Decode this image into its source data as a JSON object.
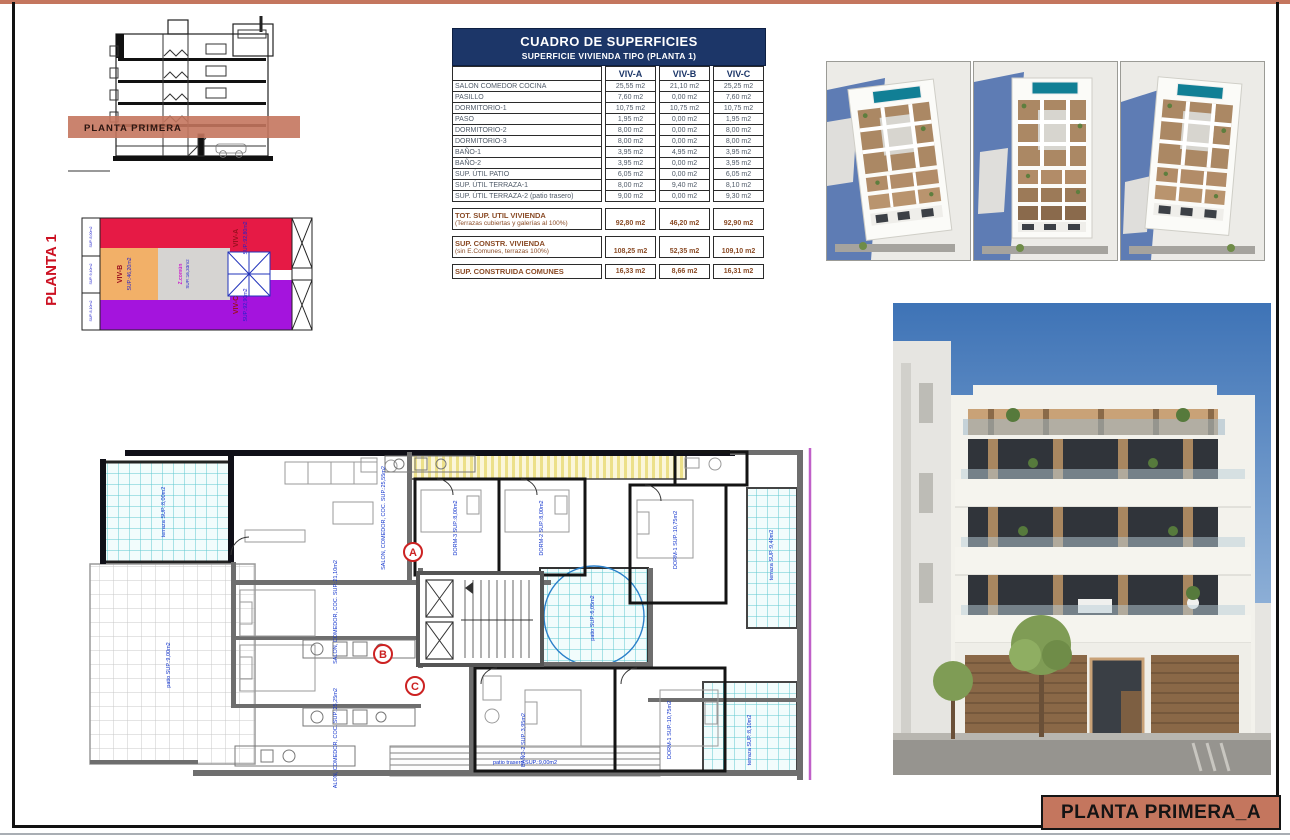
{
  "page": {
    "banner_title": "PLANTA PRIMERA_A",
    "accent_color": "#c4765e"
  },
  "section_drawing": {
    "band_label": "PLANTA PRIMERA"
  },
  "key_plan": {
    "title": "PLANTA 1",
    "units": [
      {
        "label": "VIV-A",
        "sup": "SUP.:92,80m2",
        "color": "#e61a45"
      },
      {
        "label": "VIV-B",
        "sup": "SUP.:46,20m2",
        "color": "#f2b068"
      },
      {
        "label": "VIV-C",
        "sup": "SUP.:92,90m2",
        "color": "#a414dd"
      },
      {
        "label": "Z.común",
        "sup": "SUP.:16,33m2",
        "color": "#d6d4d2"
      }
    ],
    "balcony_labels": [
      "SUP.:8,00m2",
      "SUP.:9,40m2",
      "SUP.:8,10m2"
    ]
  },
  "surface_table": {
    "title": "CUADRO DE SUPERFICIES",
    "subtitle": "SUPERFICIE VIVIENDA TIPO  (PLANTA 1)",
    "columns": {
      "a": "VIV-A",
      "b": "VIV-B",
      "c": "VIV-C"
    },
    "rows": [
      {
        "label": "SALON COMEDOR COCINA",
        "a": "25,55 m2",
        "b": "21,10 m2",
        "c": "25,25 m2"
      },
      {
        "label": "PASILLO",
        "a": "7,60 m2",
        "b": "0,00 m2",
        "c": "7,60 m2"
      },
      {
        "label": "DORMITORIO-1",
        "a": "10,75 m2",
        "b": "10,75 m2",
        "c": "10,75 m2"
      },
      {
        "label": "PASO",
        "a": "1,95 m2",
        "b": "0,00 m2",
        "c": "1,95 m2"
      },
      {
        "label": "DORMITORIO-2",
        "a": "8,00 m2",
        "b": "0,00 m2",
        "c": "8,00 m2"
      },
      {
        "label": "DORMITORIO-3",
        "a": "8,00 m2",
        "b": "0,00 m2",
        "c": "8,00 m2"
      },
      {
        "label": "BAÑO-1",
        "a": "3,95 m2",
        "b": "4,95 m2",
        "c": "3,95 m2"
      },
      {
        "label": "BAÑO-2",
        "a": "3,95 m2",
        "b": "0,00 m2",
        "c": "3,95 m2"
      },
      {
        "label": "SUP. ÚTIL PATIO",
        "a": "6,05 m2",
        "b": "0,00 m2",
        "c": "6,05 m2"
      },
      {
        "label": "SUP. ÚTIL TERRAZA-1",
        "a": "8,00 m2",
        "b": "9,40 m2",
        "c": "8,10 m2"
      },
      {
        "label": "SUP. ÚTIL TERRAZA-2 (patio trasero)",
        "a": "9,00 m2",
        "b": "0,00 m2",
        "c": "9,30 m2"
      }
    ],
    "totals": [
      {
        "l1": "TOT. SUP. UTIL VIVIENDA",
        "l2": "(Terrazas cubiertas y galerías al 100%)",
        "a": "92,80 m2",
        "b": "46,20 m2",
        "c": "92,90 m2"
      },
      {
        "l1": "SUP. CONSTR. VIVIENDA",
        "l2": "(sin E.Comunes, terrazas 100%)",
        "a": "108,25 m2",
        "b": "52,35 m2",
        "c": "109,10 m2"
      },
      {
        "l1": "SUP. CONSTRUIDA COMUNES",
        "l2": "",
        "a": "16,33 m2",
        "b": "8,66 m2",
        "c": "16,31 m2"
      }
    ]
  },
  "floor_plan": {
    "markers": {
      "a": "A",
      "b": "B",
      "c": "C"
    },
    "labels": [
      {
        "text": "terraza SUP.:8,00m2"
      },
      {
        "text": "SALON, COMEDOR, COC. SUP.:25,55m2"
      },
      {
        "text": "DORM-3 SUP.:8,00m2"
      },
      {
        "text": "DORM-2 SUP.:8,00m2"
      },
      {
        "text": "DORM-1 SUP.:10,75m2"
      },
      {
        "text": "terraza SUP.:9,40m2"
      },
      {
        "text": "patio SUP.:6,05m2"
      },
      {
        "text": "patio SUP.:9,00m2"
      },
      {
        "text": "BAÑO-2 SUP.:3,95m2"
      },
      {
        "text": "DORM-1 SUP.:10,75m2"
      },
      {
        "text": "SALON, COMEDOR, COC. SUP.:21,10m2"
      },
      {
        "text": "SALON, COMEDOR, COC. SUP.:25,25m2"
      },
      {
        "text": "patio trasero SUP.:9,00m2"
      },
      {
        "text": "terraza SUP.:8,10m2"
      }
    ]
  }
}
